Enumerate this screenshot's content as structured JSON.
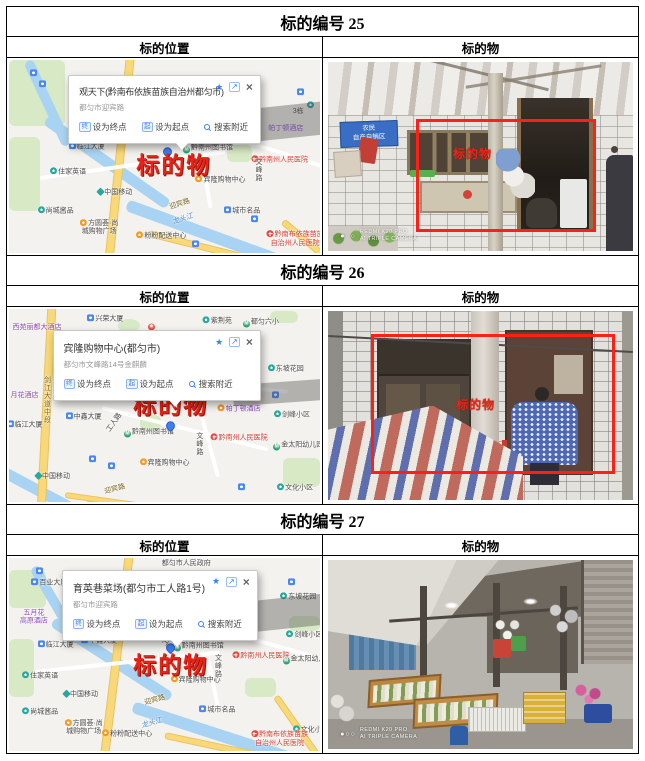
{
  "icons": {
    "star": "★",
    "share": "↗",
    "close": "×"
  },
  "sections": [
    {
      "header": "标的编号 25",
      "location_label": "标的位置",
      "object_label": "标的物",
      "map": {
        "popup": {
          "title": "观天下(黔南布依族苗族自治州都匀市)",
          "subtitle": "都匀市迎宾路",
          "ico_end": "终",
          "act_end": "设为终点",
          "ico_start": "起",
          "act_start": "设为起点",
          "act_near": "搜索附近"
        },
        "labels": [
          {
            "t": "",
            "x": 8,
            "y": 7,
            "k": "ic",
            "i": "bus"
          },
          {
            "t": "",
            "x": 11,
            "y": 13,
            "k": "ic",
            "i": "bus"
          },
          {
            "t": "3栋",
            "x": 93,
            "y": 27,
            "k": "plain"
          },
          {
            "t": "帕丁顿酒店",
            "x": 89,
            "y": 36,
            "k": "purple"
          },
          {
            "t": "",
            "x": 94,
            "y": 17,
            "k": "ic",
            "i": "bus"
          },
          {
            "t": "",
            "x": 97,
            "y": 24,
            "k": "ic",
            "i": "metro"
          },
          {
            "t": "临江大厦",
            "x": 25,
            "y": 45,
            "k": "plain",
            "i": "bus"
          },
          {
            "t": "中鑫大厦",
            "x": 43,
            "y": 40,
            "k": "plain",
            "i": "bus"
          },
          {
            "t": "工人路",
            "x": 55,
            "y": 38,
            "k": "plain",
            "r": -55
          },
          {
            "t": "黔南州图书馆",
            "x": 64,
            "y": 46,
            "k": "plain",
            "i": "metro2"
          },
          {
            "t": "",
            "x": 51,
            "y": 48,
            "k": "ic",
            "i": "pin"
          },
          {
            "t": "标的物",
            "x": 53,
            "y": 55,
            "k": "target"
          },
          {
            "t": "宾隆购物中心",
            "x": 68,
            "y": 62,
            "k": "plain",
            "i": "shop"
          },
          {
            "t": "黔南州人民医院",
            "x": 87,
            "y": 52,
            "k": "red",
            "i": "hosp"
          },
          {
            "t": "文峰路",
            "x": 80,
            "y": 57,
            "k": "plain",
            "v": 1
          },
          {
            "t": "住家英语",
            "x": 19,
            "y": 58,
            "k": "plain",
            "i": "metro"
          },
          {
            "t": "中国移动",
            "x": 34,
            "y": 69,
            "k": "plain",
            "i": "mob"
          },
          {
            "t": "尚城酱品",
            "x": 15,
            "y": 78,
            "k": "plain",
            "i": "metro"
          },
          {
            "t": "方圆荟·尚\n城购物广场",
            "x": 29,
            "y": 87,
            "k": "plain2",
            "i": "shop"
          },
          {
            "t": "粉粉配送中心",
            "x": 49,
            "y": 91,
            "k": "plain",
            "i": "shop"
          },
          {
            "t": "迎宾路",
            "x": 55,
            "y": 75,
            "k": "road",
            "r": -18
          },
          {
            "t": "龙头江",
            "x": 56,
            "y": 83,
            "k": "river",
            "r": -18
          },
          {
            "t": "城市名品",
            "x": 75,
            "y": 78,
            "k": "plain",
            "i": "bus"
          },
          {
            "t": "黔南布依族苗族\n自治州人民医院",
            "x": 92,
            "y": 93,
            "k": "red2",
            "i": "hosp"
          },
          {
            "t": "",
            "x": 60,
            "y": 96,
            "k": "ic",
            "i": "bus"
          },
          {
            "t": "",
            "x": 79,
            "y": 83,
            "k": "ic",
            "i": "bus"
          }
        ]
      },
      "photo": {
        "sign_line1": "农民",
        "sign_line2": "自产自销区",
        "target": "标的物",
        "wm_dots": "●○○",
        "wm_line1": "REDMI K20 PRO",
        "wm_line2": "AI TRIPLE CAMERA"
      }
    },
    {
      "header": "标的编号 26",
      "location_label": "标的位置",
      "object_label": "标的物",
      "map": {
        "popup": {
          "title": "宾隆购物中心(都匀市)",
          "subtitle": "都匀市文峰路14号金麒麟",
          "ico_end": "终",
          "act_end": "设为终点",
          "ico_start": "起",
          "act_start": "设为起点",
          "act_near": "搜索附近"
        },
        "labels": [
          {
            "t": "西苑丽都大酒店",
            "x": 9,
            "y": 10,
            "k": "purple"
          },
          {
            "t": "兴荣大厦",
            "x": 31,
            "y": 5,
            "k": "plain",
            "i": "bus"
          },
          {
            "t": "",
            "x": 46,
            "y": 9,
            "k": "ic",
            "i": "star"
          },
          {
            "t": "紫荆苑",
            "x": 67,
            "y": 6,
            "k": "plain",
            "i": "metro"
          },
          {
            "t": "都匀六小",
            "x": 81,
            "y": 7,
            "k": "plain",
            "i": "metro2"
          },
          {
            "t": "东坡花园",
            "x": 89,
            "y": 31,
            "k": "plain",
            "i": "metro"
          },
          {
            "t": "月花酒店",
            "x": 5,
            "y": 45,
            "k": "purple"
          },
          {
            "t": "剑江大道中段",
            "x": 12,
            "y": 47,
            "k": "roadv",
            "v": 1
          },
          {
            "t": "临江大厦",
            "x": 5,
            "y": 60,
            "k": "plain",
            "i": "bus"
          },
          {
            "t": "中鑫大厦",
            "x": 24,
            "y": 56,
            "k": "plain",
            "i": "bus"
          },
          {
            "t": "标的物",
            "x": 52,
            "y": 50,
            "k": "target"
          },
          {
            "t": "帕丁顿酒店",
            "x": 74,
            "y": 52,
            "k": "purple",
            "i": "shop"
          },
          {
            "t": "剑峰小区",
            "x": 91,
            "y": 55,
            "k": "plain",
            "i": "metro"
          },
          {
            "t": "工人路",
            "x": 34,
            "y": 59,
            "k": "plain",
            "r": -55
          },
          {
            "t": "黔南州图书馆",
            "x": 45,
            "y": 64,
            "k": "plain",
            "i": "metro2"
          },
          {
            "t": "",
            "x": 52,
            "y": 61,
            "k": "ic",
            "i": "pin"
          },
          {
            "t": "文峰路",
            "x": 61,
            "y": 70,
            "k": "plain",
            "v": 1
          },
          {
            "t": "黔南州人民医院",
            "x": 74,
            "y": 67,
            "k": "red",
            "i": "hosp"
          },
          {
            "t": "金太阳幼儿园",
            "x": 93,
            "y": 71,
            "k": "plain",
            "i": "metro2"
          },
          {
            "t": "宾隆购物中心",
            "x": 50,
            "y": 80,
            "k": "plain",
            "i": "shop"
          },
          {
            "t": "中国移动",
            "x": 14,
            "y": 87,
            "k": "plain",
            "i": "mob"
          },
          {
            "t": "迎宾路",
            "x": 34,
            "y": 94,
            "k": "road",
            "r": -14
          },
          {
            "t": "文化小区",
            "x": 92,
            "y": 93,
            "k": "plain",
            "i": "metro"
          },
          {
            "t": "",
            "x": 86,
            "y": 45,
            "k": "ic",
            "i": "bus"
          },
          {
            "t": "",
            "x": 27,
            "y": 78,
            "k": "ic",
            "i": "bus"
          },
          {
            "t": "",
            "x": 33,
            "y": 82,
            "k": "ic",
            "i": "bus"
          },
          {
            "t": "",
            "x": 75,
            "y": 93,
            "k": "ic",
            "i": "bus"
          }
        ]
      },
      "photo": {
        "target": "标的物"
      }
    },
    {
      "header": "标的编号 27",
      "location_label": "标的位置",
      "object_label": "标的物",
      "map": {
        "popup": {
          "title": "育英巷菜场(都匀市工人路1号)",
          "subtitle": "都匀市迎宾路",
          "ico_end": "终",
          "act_end": "设为终点",
          "ico_start": "起",
          "act_start": "设为起点",
          "act_near": "搜索附近"
        },
        "labels": [
          {
            "t": "都匀市人民政府",
            "x": 57,
            "y": 3,
            "k": "plain"
          },
          {
            "t": "百业大厦",
            "x": 13,
            "y": 13,
            "k": "plain",
            "i": "bus"
          },
          {
            "t": "东坡花园",
            "x": 93,
            "y": 20,
            "k": "plain",
            "i": "metro"
          },
          {
            "t": "五月花\n高原酒店",
            "x": 8,
            "y": 31,
            "k": "purple2"
          },
          {
            "t": "临江大厦",
            "x": 15,
            "y": 45,
            "k": "plain",
            "i": "bus"
          },
          {
            "t": "中鑫大厦",
            "x": 29,
            "y": 43,
            "k": "plain",
            "i": "bus"
          },
          {
            "t": "剑峰小区",
            "x": 95,
            "y": 40,
            "k": "plain",
            "i": "metro"
          },
          {
            "t": "工人路",
            "x": 52,
            "y": 41,
            "k": "plain",
            "r": -55
          },
          {
            "t": "黔南州图书馆",
            "x": 61,
            "y": 46,
            "k": "plain",
            "i": "metro2"
          },
          {
            "t": "",
            "x": 52,
            "y": 47,
            "k": "ic",
            "i": "pin"
          },
          {
            "t": "标的物",
            "x": 52,
            "y": 56,
            "k": "target"
          },
          {
            "t": "文峰路",
            "x": 67,
            "y": 56,
            "k": "plain",
            "v": 1
          },
          {
            "t": "黔南州人民医院",
            "x": 81,
            "y": 51,
            "k": "red",
            "i": "hosp"
          },
          {
            "t": "金太阳幼儿园",
            "x": 96,
            "y": 53,
            "k": "plain",
            "i": "metro2"
          },
          {
            "t": "住家英语",
            "x": 10,
            "y": 61,
            "k": "plain",
            "i": "metro"
          },
          {
            "t": "宾隆购物中心",
            "x": 60,
            "y": 63,
            "k": "plain",
            "i": "shop"
          },
          {
            "t": "中国移动",
            "x": 23,
            "y": 71,
            "k": "plain",
            "i": "mob"
          },
          {
            "t": "尚城酱品",
            "x": 10,
            "y": 80,
            "k": "plain",
            "i": "metro"
          },
          {
            "t": "方圆荟·尚\n城购物广场",
            "x": 24,
            "y": 88,
            "k": "plain2",
            "i": "shop"
          },
          {
            "t": "粉粉配送中心",
            "x": 38,
            "y": 91,
            "k": "plain",
            "i": "shop"
          },
          {
            "t": "迎宾路",
            "x": 47,
            "y": 74,
            "k": "road",
            "r": -16
          },
          {
            "t": "龙头江",
            "x": 46,
            "y": 86,
            "k": "river",
            "r": -16
          },
          {
            "t": "城市名品",
            "x": 67,
            "y": 79,
            "k": "plain",
            "i": "bus"
          },
          {
            "t": "文化小区",
            "x": 97,
            "y": 89,
            "k": "plain",
            "i": "metro"
          },
          {
            "t": "黔南布依族苗族\n自治州人民医院",
            "x": 87,
            "y": 94,
            "k": "red2",
            "i": "hosp"
          },
          {
            "t": "",
            "x": 10,
            "y": 7,
            "k": "ic",
            "i": "bus"
          },
          {
            "t": "",
            "x": 91,
            "y": 13,
            "k": "ic",
            "i": "bus"
          }
        ]
      },
      "photo": {
        "wm_dots": "●○○",
        "wm_line1": "REDMI K20 PRO",
        "wm_line2": "AI TRIPLE CAMERA"
      }
    }
  ]
}
